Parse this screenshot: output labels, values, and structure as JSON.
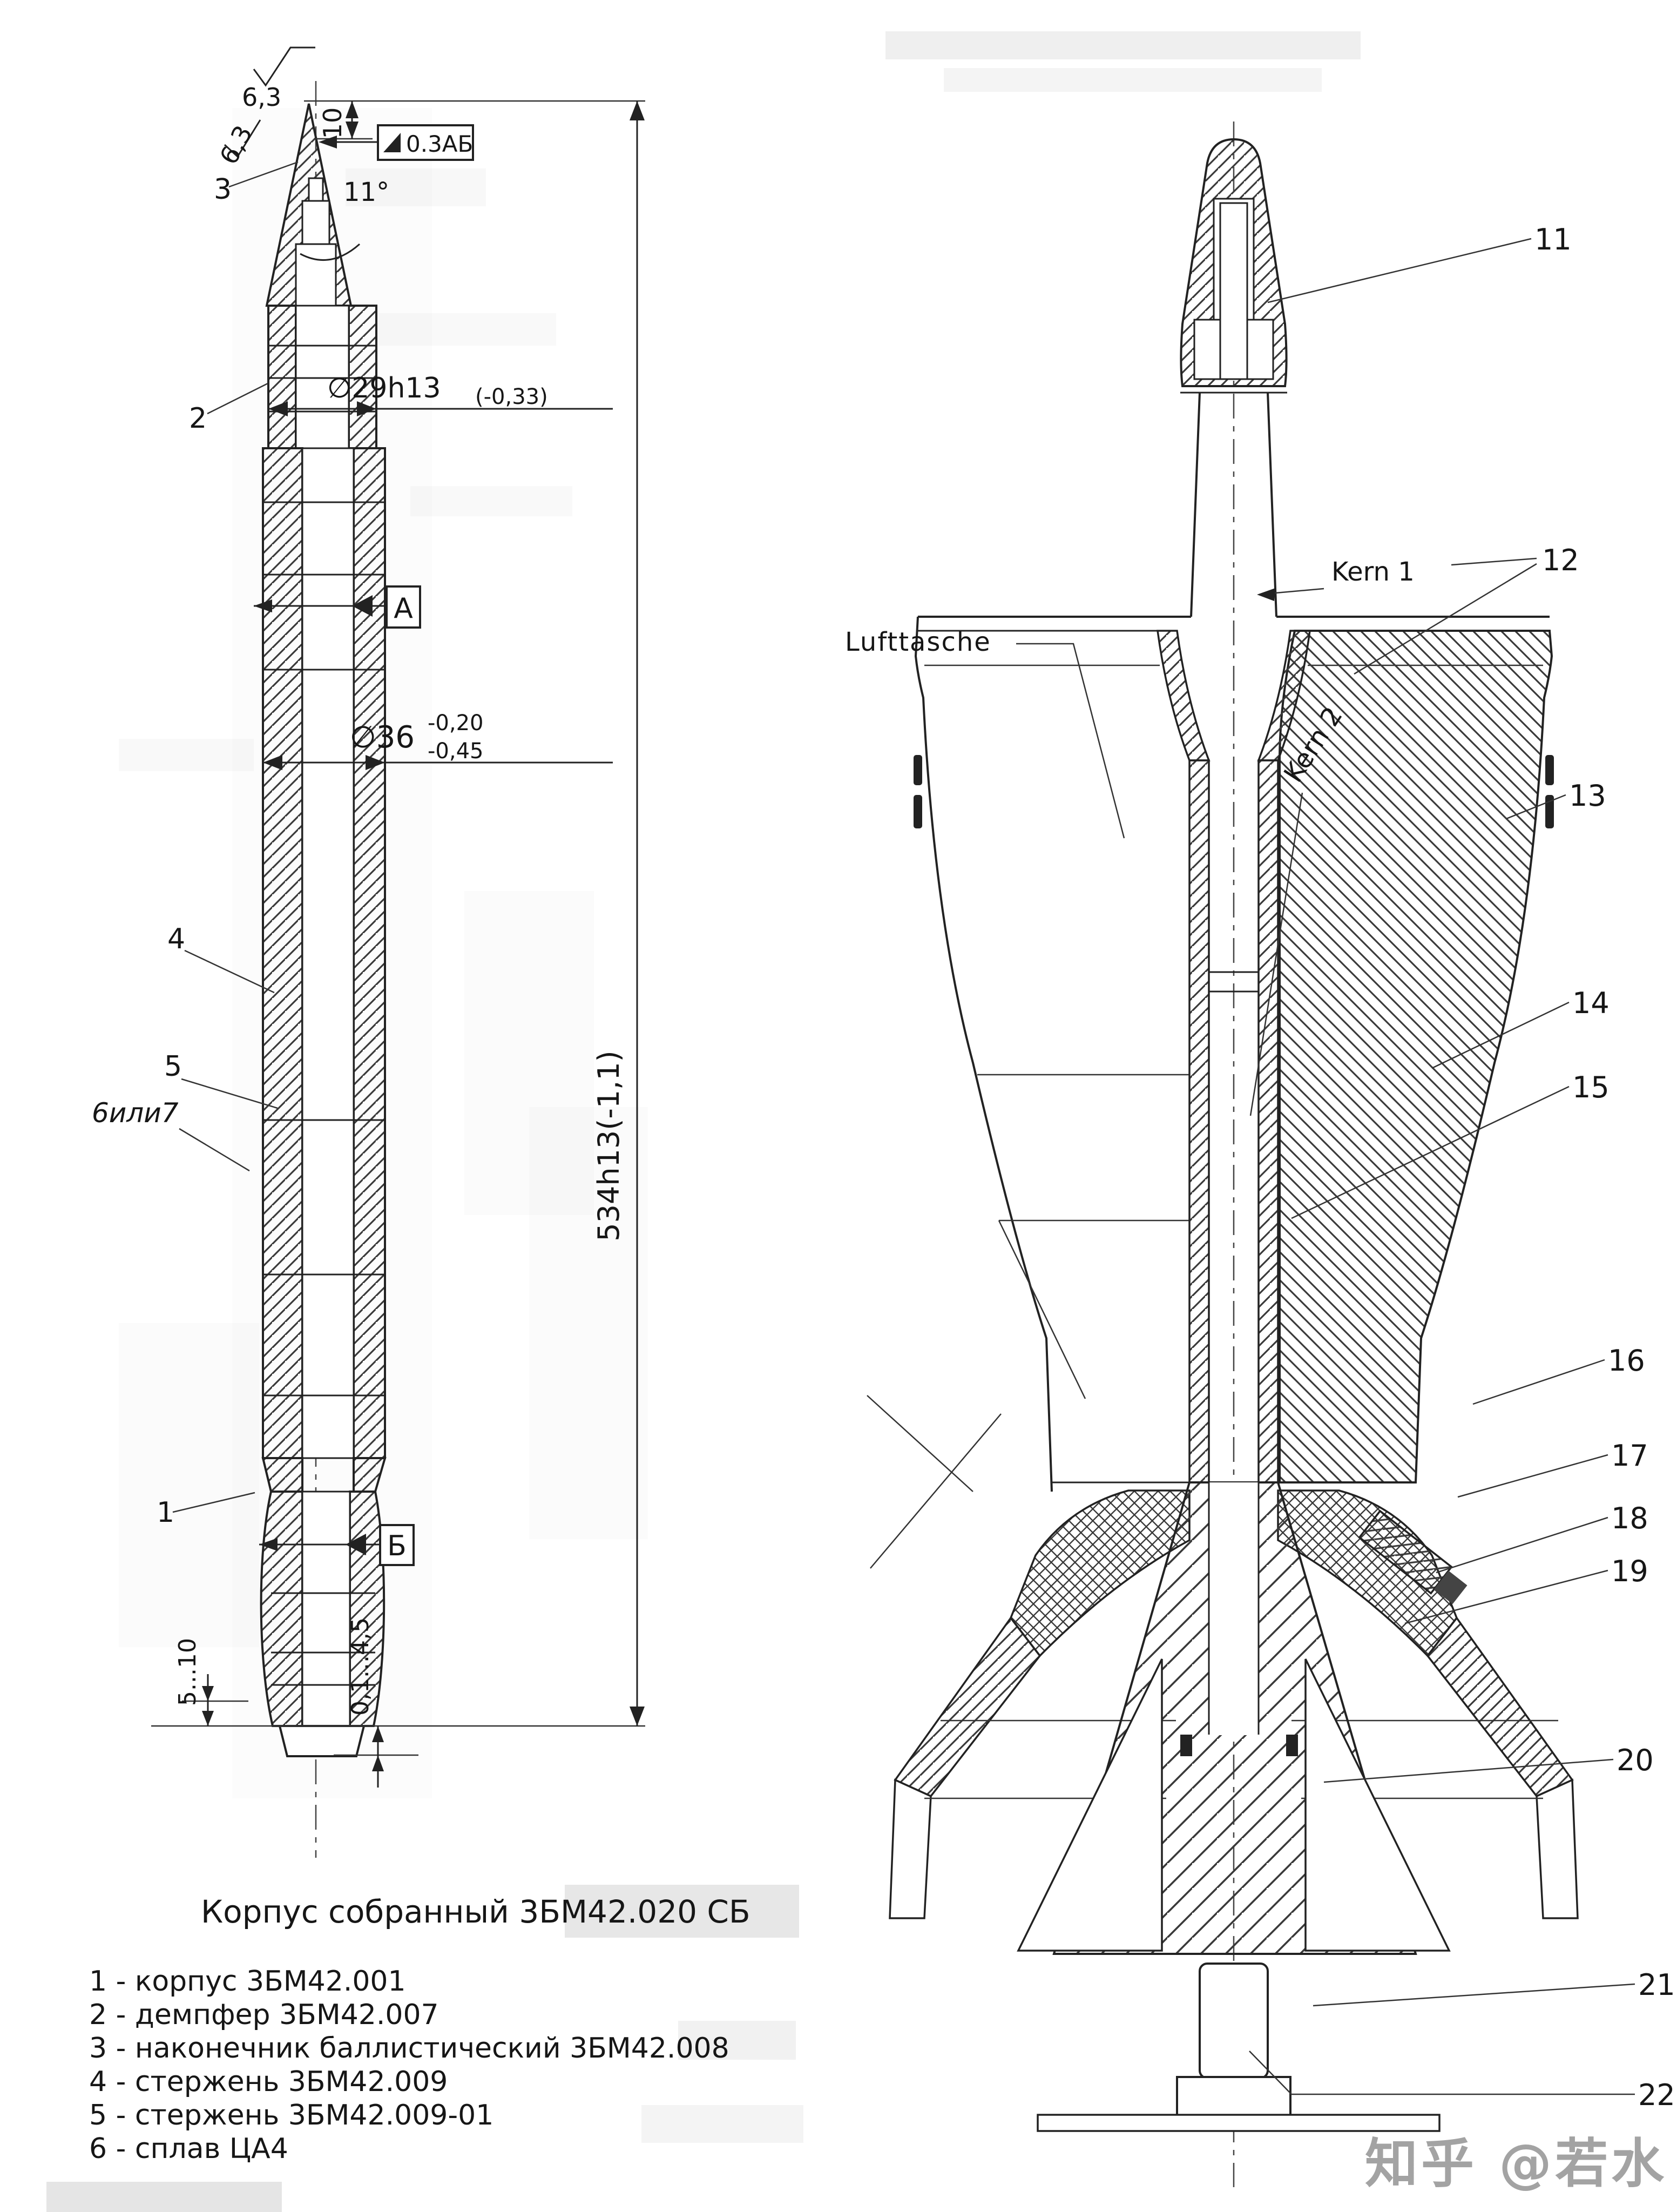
{
  "page": {
    "background": "#ffffff",
    "ink": "#222222",
    "watermark_color": "#a3a3a3"
  },
  "watermark": {
    "text": "知乎 @若水"
  },
  "caption": {
    "text": "Корпус собранный 3БМ42.020 СБ"
  },
  "legend": {
    "items": [
      "1 - корпус 3БМ42.001",
      "2 - демпфер 3БМ42.007",
      "3 - наконечник баллистический 3БМ42.008",
      "4 - стержень 3БМ42.009",
      "5 - стержень 3БМ42.009-01",
      "6 - сплав ЦА4"
    ]
  },
  "left": {
    "title_hint": "assembled body drawing with GOST dimensions",
    "dims": {
      "rough_top": "6,3",
      "rough_side": "6,3",
      "len10": "10",
      "angle": "11°",
      "taper": "0.3АБ",
      "d29main": "∅29h13",
      "d29tol": "(-0,33)",
      "datumA": "А",
      "d36main": "∅36",
      "d36hi": "-0,20",
      "d36lo": "-0,45",
      "len534": "534h13(-1,1)",
      "datumB": "Б",
      "gap510": "5...10",
      "gap0145": "0,1...4,5"
    },
    "callouts": [
      "3",
      "2",
      "4",
      "5",
      "6или7",
      "1"
    ]
  },
  "right": {
    "title_hint": "German sectioned round drawing",
    "labels": {
      "lufttasche": "Lufttasche",
      "kern1": "Kern 1",
      "kern2": "Kern 2"
    },
    "callouts": [
      "11",
      "12",
      "13",
      "14",
      "15",
      "16",
      "17",
      "18",
      "19",
      "20",
      "21",
      "22"
    ]
  }
}
